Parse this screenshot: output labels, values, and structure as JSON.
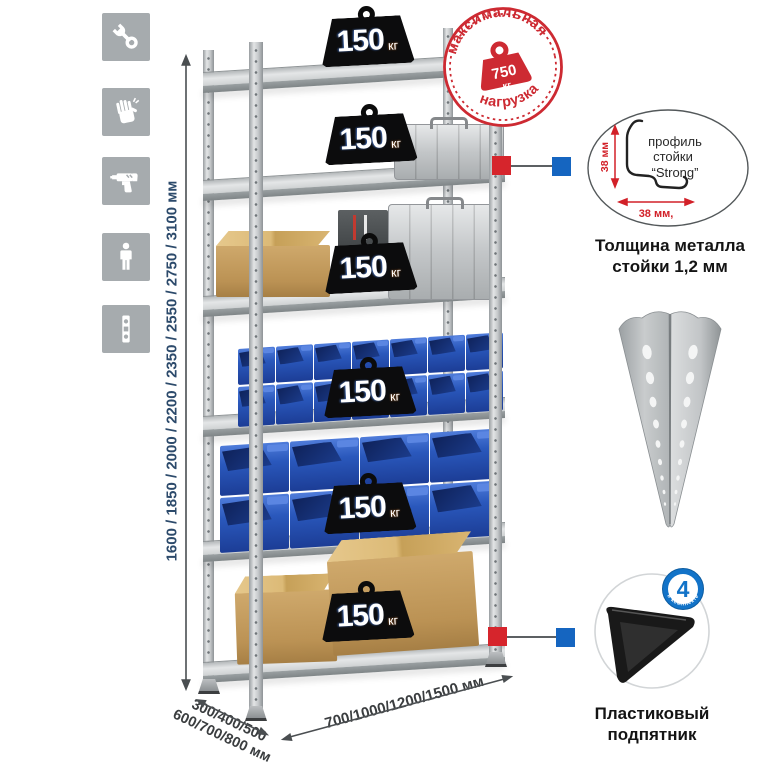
{
  "stamp": {
    "arc_top": "максимальная",
    "arc_bottom": "нагрузка",
    "value": "750",
    "unit": "кг"
  },
  "loads": [
    {
      "value": "150",
      "unit": "кг"
    },
    {
      "value": "150",
      "unit": "кг"
    },
    {
      "value": "150",
      "unit": "кг"
    },
    {
      "value": "150",
      "unit": "кг"
    },
    {
      "value": "150",
      "unit": "кг"
    },
    {
      "value": "150",
      "unit": "кг"
    }
  ],
  "dims": {
    "height": "1600 / 1850 / 2000 / 2200 / 2350 / 2550 / 2750 / 3100 мм",
    "depth1": "300/400/500",
    "depth2": "600/700/800 мм",
    "width": "700/1000/1200/1500 мм"
  },
  "profile": {
    "l1": "профиль",
    "l2": "стойки",
    "l3": "“Strong”",
    "dv": "38 мм",
    "dh": "38 мм,",
    "cap1": "Толщина металла",
    "cap2": "стойки 1,2 мм"
  },
  "foot": {
    "badge": "4",
    "badge_arc": "в комплекте",
    "cap1": "Пластиковый",
    "cap2": "подпятник"
  },
  "colors": {
    "accent_red": "#d6252c",
    "accent_blue": "#1565c0",
    "bin_blue": "#2a58bc",
    "dim_navy": "#2c4a6b"
  }
}
